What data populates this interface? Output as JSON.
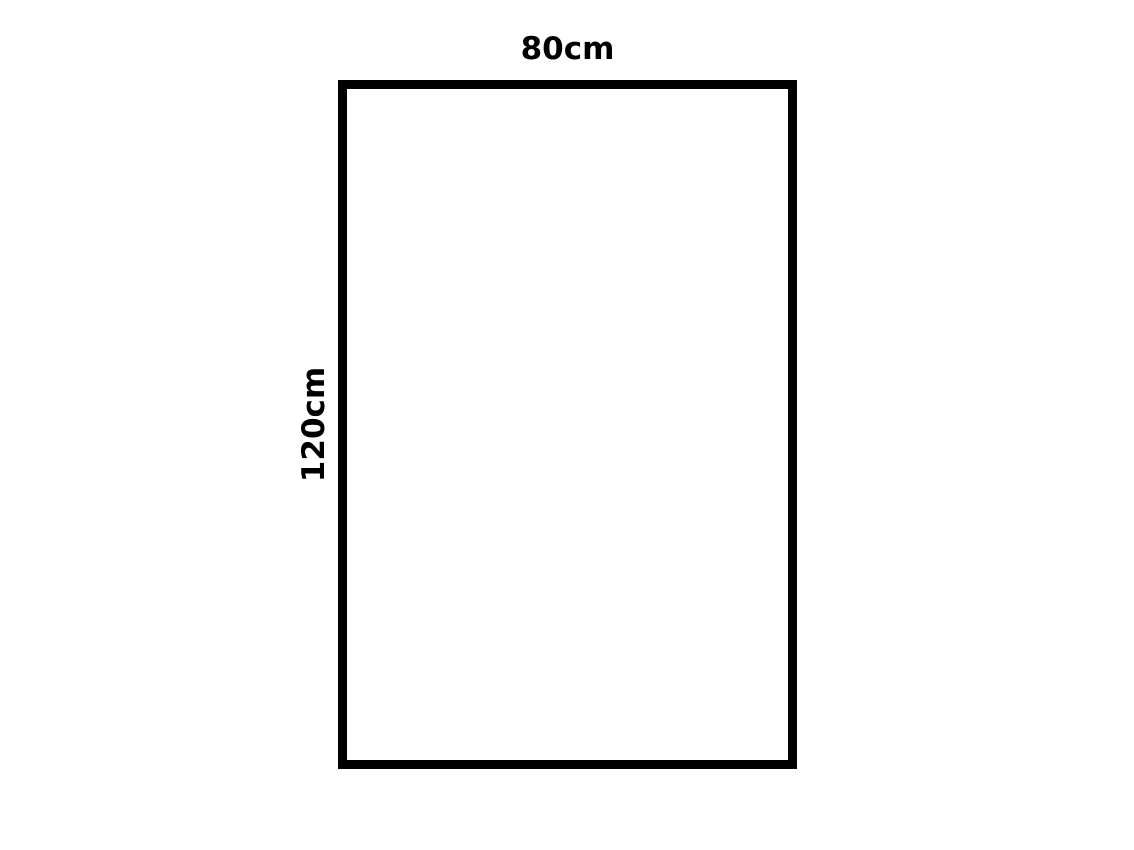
{
  "diagram": {
    "shape": "rectangle",
    "stroke_color": "#000000",
    "fill_color": "#ffffff",
    "background_color": "#ffffff",
    "width_label": "80cm",
    "height_label": "120cm"
  }
}
